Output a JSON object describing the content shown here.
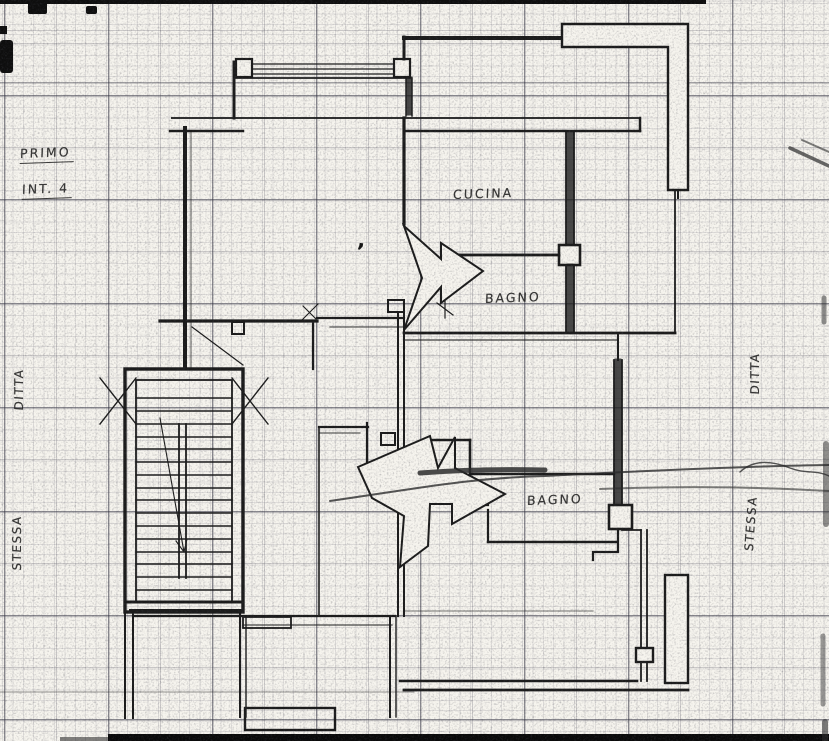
{
  "colors": {
    "paper": "#f6f4ee",
    "ink": "#1b1b1b"
  },
  "plan": {
    "floor_label": "PRIMO",
    "unit_label": "INT. 4",
    "room_labels": [
      {
        "id": "cucina",
        "text": "CUCINA"
      },
      {
        "id": "bagno-1",
        "text": "BAGNO"
      },
      {
        "id": "bagno-2",
        "text": "BAGNO"
      }
    ],
    "margin_labels": [
      {
        "id": "ditta-left",
        "text": "DITTA"
      },
      {
        "id": "stessa-left",
        "text": "STESSA"
      },
      {
        "id": "ditta-right",
        "text": "DITTA"
      },
      {
        "id": "stessa-right",
        "text": "STESSA"
      }
    ],
    "stray_mark": ","
  }
}
